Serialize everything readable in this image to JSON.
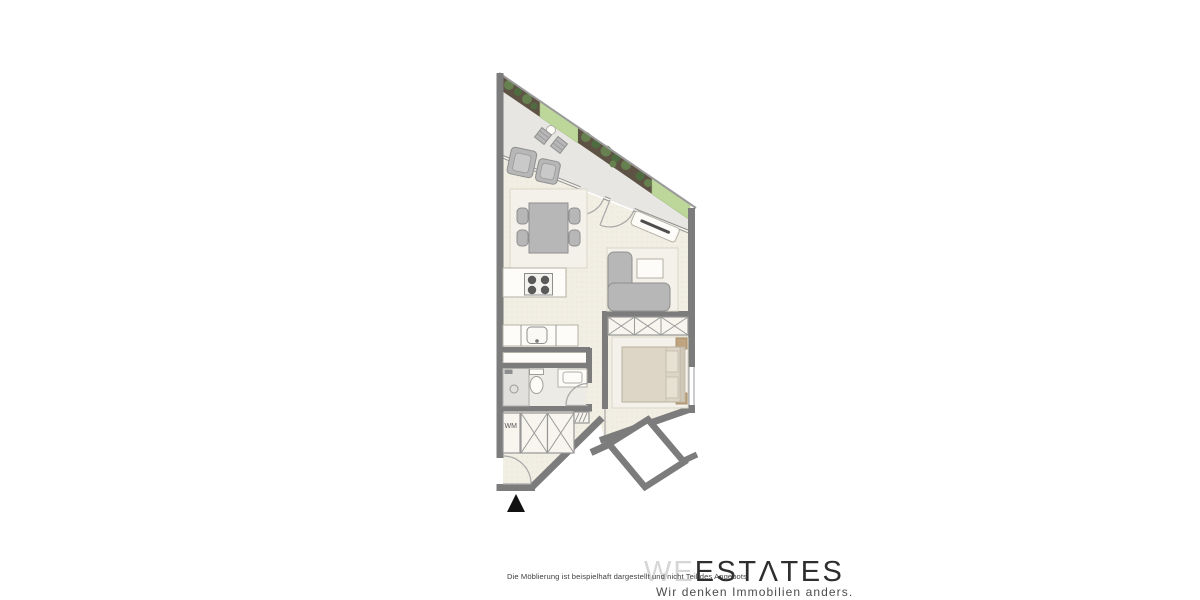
{
  "footer": {
    "disclaimer": "Die Möblierung ist beispielhaft dargestellt und nicht Teil des Angebots.",
    "brand": {
      "prefix": "WE",
      "suffix": "ESTΛTES",
      "tagline": "Wir denken Immobilien anders."
    }
  },
  "floorplan": {
    "labels": {
      "washing_machine": "WM"
    },
    "colors": {
      "wall": "#7c7c7c",
      "floor": "#f1eee3",
      "balcony_floor": "#e7e6e3",
      "lawn_green": "#bdd79b",
      "planter_brown": "#5e5244",
      "plant_green": "#66804f",
      "furniture_gray": "#b7b7b7",
      "rug": "#f3f1e9",
      "bed_beige": "#ddd6c7",
      "wood_tan": "#c0a37f",
      "brand_light": "#d6d6d6",
      "brand_dark": "#2e2e2e",
      "entrance_marker": "#111111"
    }
  }
}
